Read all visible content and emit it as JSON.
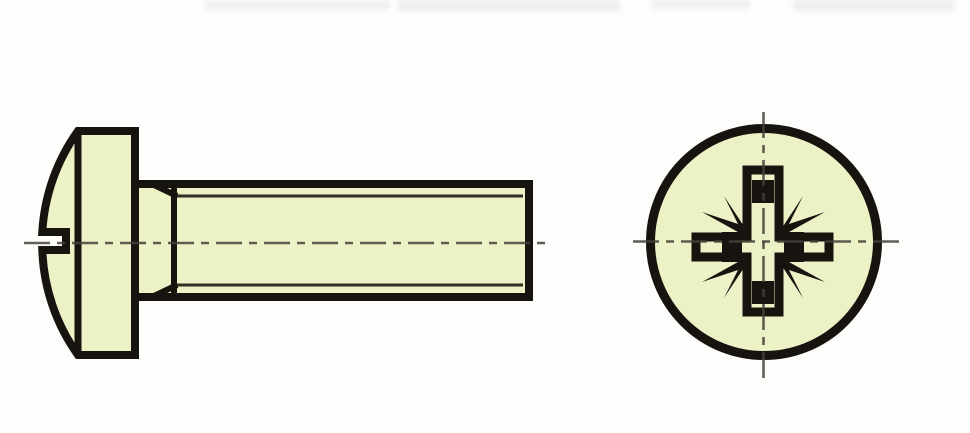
{
  "page": {
    "description": "Technical line drawing of a pan head machine screw with Pozidriv cross recess: side view with threaded shank on the left, head-on view of the recess on the right",
    "views": [
      {
        "id": "side-view",
        "label": "Side view of pan head screw with threaded shank"
      },
      {
        "id": "front-view",
        "label": "Head-on view of pan head with Pozidriv cross recess"
      }
    ],
    "parts": {
      "side_view": [
        "pan-head-dome",
        "recess-slot-notch",
        "dome-tangent-line",
        "head-bearing-face",
        "thread-runout-chamfer",
        "threaded-shank",
        "thread-minor-diameter-lines",
        "shank-end-face",
        "horizontal-center-line"
      ],
      "front_view": [
        "head-outline-circle",
        "pozidriv-cross-recess",
        "recess-wing-slots",
        "recess-tip-blocks",
        "pozidriv-identification-ticks",
        "vertical-center-line",
        "horizontal-center-line"
      ]
    },
    "colors": {
      "background": "#fdfdfc",
      "material_fill": "#ecf1c6",
      "outline": "#17130e",
      "centerline": "#45423a",
      "top_smudge": "#d4d1dc"
    }
  }
}
